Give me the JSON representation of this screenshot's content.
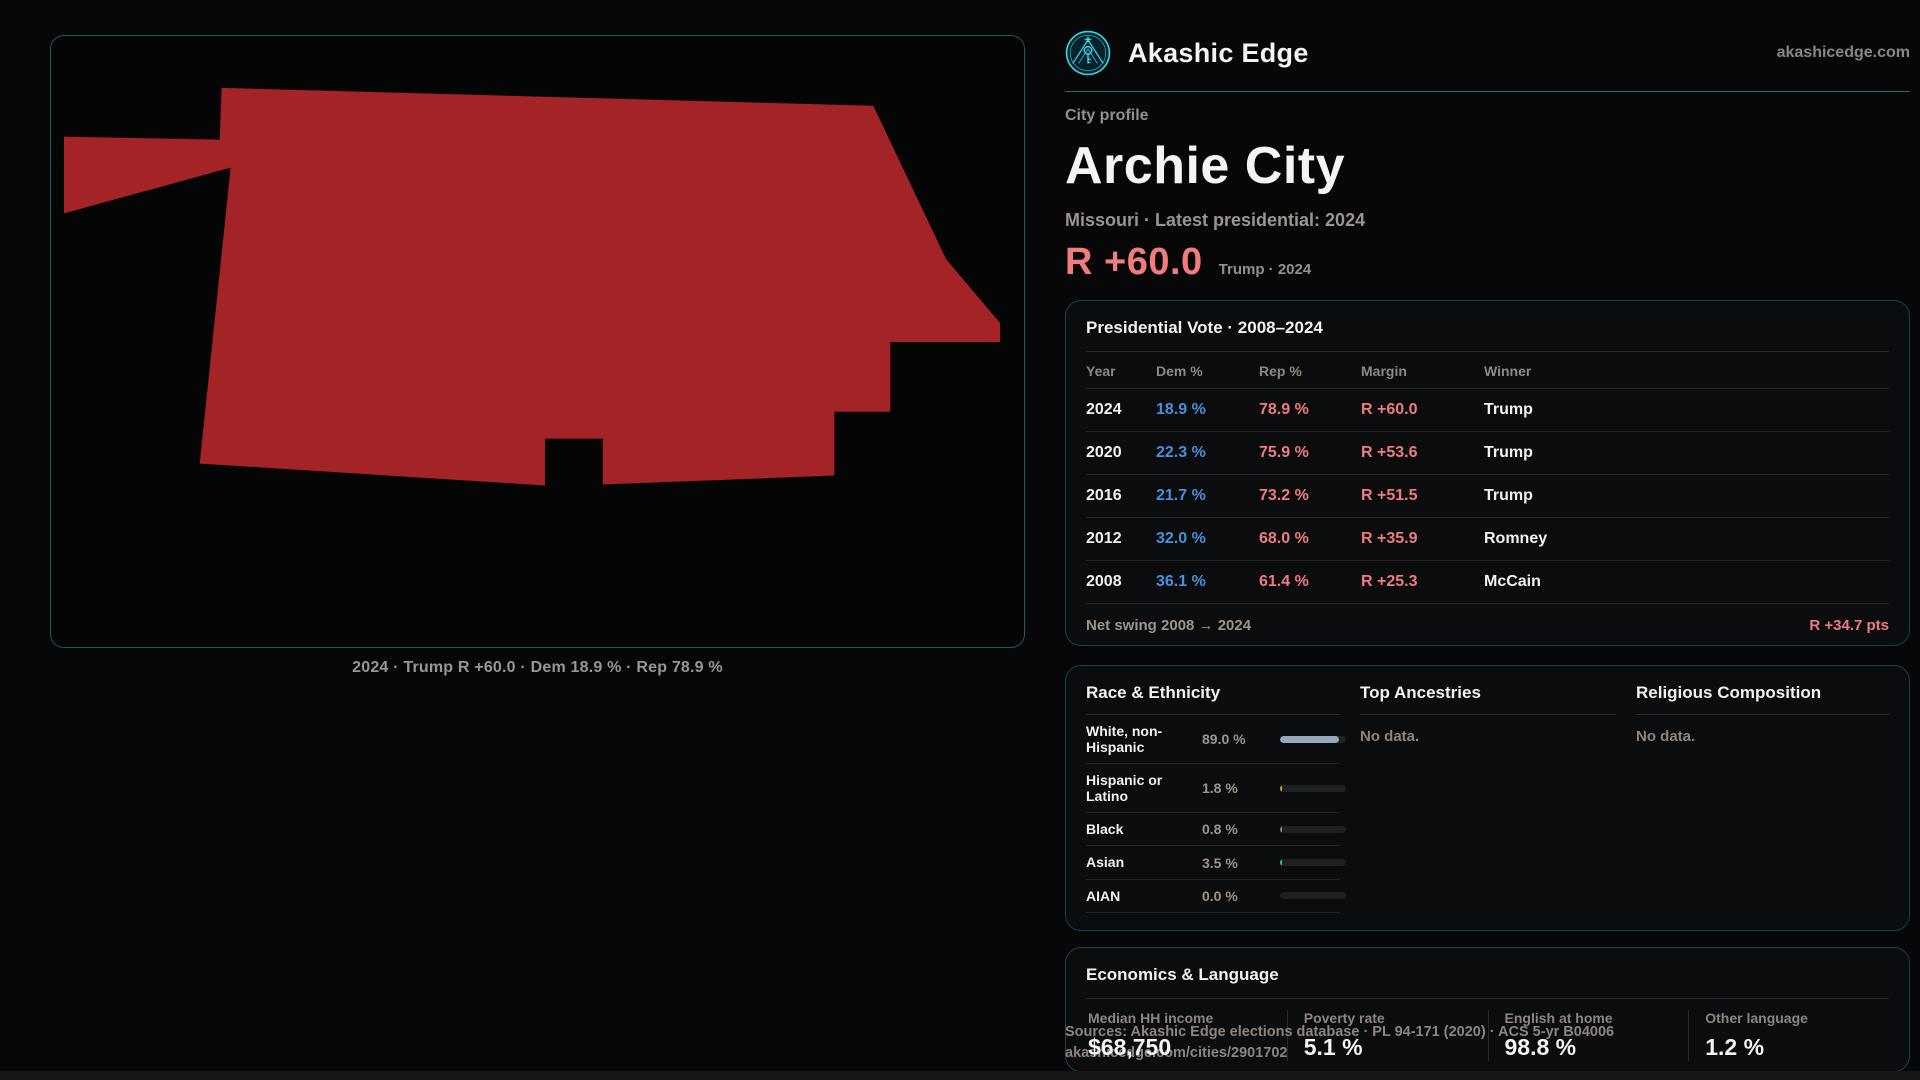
{
  "brand": {
    "name": "Akashic Edge",
    "domain": "akashicedge.com",
    "accent_color": "#3ed0e4"
  },
  "profile": {
    "eyebrow": "City profile",
    "title": "Archie City",
    "subtitle": "Missouri · Latest presidential: 2024",
    "headline_margin": "R +60.0",
    "headline_context": "Trump · 2024",
    "margin_color": "#f17c7c"
  },
  "map": {
    "caption": "2024 · Trump R +60.0 · Dem 18.9 % · Rep 78.9 %",
    "fill_color": "#a32327",
    "outline": "171,52 824,70 897,224 951,288 951,307 841,307 841,377 785,377 785,441 553,450 553,404 495,404 495,451 149,429 180,132 13,178 13,101 169,104"
  },
  "elections": {
    "title": "Presidential Vote · 2008–2024",
    "columns": {
      "year": "Year",
      "dem": "Dem %",
      "rep": "Rep %",
      "margin": "Margin",
      "winner": "Winner"
    },
    "rows": [
      {
        "year": "2024",
        "dem": "18.9 %",
        "rep": "78.9 %",
        "margin": "R +60.0",
        "winner": "Trump"
      },
      {
        "year": "2020",
        "dem": "22.3 %",
        "rep": "75.9 %",
        "margin": "R +53.6",
        "winner": "Trump"
      },
      {
        "year": "2016",
        "dem": "21.7 %",
        "rep": "73.2 %",
        "margin": "R +51.5",
        "winner": "Trump"
      },
      {
        "year": "2012",
        "dem": "32.0 %",
        "rep": "68.0 %",
        "margin": "R +35.9",
        "winner": "Romney"
      },
      {
        "year": "2008",
        "dem": "36.1 %",
        "rep": "61.4 %",
        "margin": "R +25.3",
        "winner": "McCain"
      }
    ],
    "net_swing_label": "Net swing 2008 → 2024",
    "net_swing_value": "R +34.7 pts",
    "dem_color": "#4a90dd",
    "rep_color": "#f17c7c"
  },
  "demographics": {
    "race_title": "Race & Ethnicity",
    "race_rows": [
      {
        "label": "White, non-Hispanic",
        "value": "89.0 %",
        "pct": 89.0,
        "color": "#93a7bd"
      },
      {
        "label": "Hispanic or Latino",
        "value": "1.8 %",
        "pct": 1.8,
        "color": "#e09a2d"
      },
      {
        "label": "Black",
        "value": "0.8 %",
        "pct": 0.8,
        "color": "#7d8894"
      },
      {
        "label": "Asian",
        "value": "3.5 %",
        "pct": 3.5,
        "color": "#2ec4a0"
      },
      {
        "label": "AIAN",
        "value": "0.0 %",
        "pct": 0.0,
        "color": "#7d8894"
      }
    ],
    "ancestries_title": "Top Ancestries",
    "ancestries_empty": "No data.",
    "religion_title": "Religious Composition",
    "religion_empty": "No data."
  },
  "economics": {
    "title": "Economics & Language",
    "stats": [
      {
        "label": "Median HH income",
        "value": "$68,750"
      },
      {
        "label": "Poverty rate",
        "value": "5.1 %"
      },
      {
        "label": "English at home",
        "value": "98.8 %"
      },
      {
        "label": "Other language",
        "value": "1.2 %"
      }
    ]
  },
  "footer": {
    "sources": "Sources: Akashic Edge elections database · PL 94-171 (2020) · ACS 5-yr B04006",
    "permalink": "akashicedge.com/cities/2901702"
  },
  "chart_data": {
    "type": "bar",
    "title": "Race & Ethnicity (%)",
    "categories": [
      "White, non-Hispanic",
      "Hispanic or Latino",
      "Black",
      "Asian",
      "AIAN"
    ],
    "values": [
      89.0,
      1.8,
      0.8,
      3.5,
      0.0
    ],
    "xlabel": "",
    "ylabel": "Share of population",
    "ylim": [
      0,
      100
    ]
  }
}
